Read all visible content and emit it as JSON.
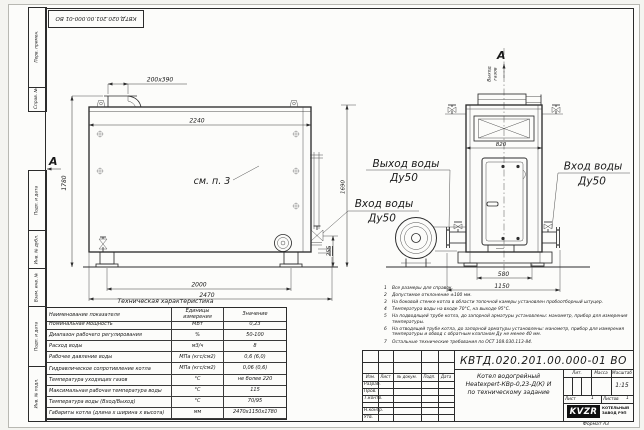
{
  "frame": {
    "strip_top": [
      "Перв. примен.",
      "Справ. №"
    ],
    "strip_bottom": [
      "Подп. и дата",
      "Инв. № дубл.",
      "Взам. инв. №",
      "Подп. и дата",
      "Инв. № подл."
    ]
  },
  "views": {
    "front": {
      "section_mark": "А",
      "see_ref": "см. п. 3",
      "dim_duct": "200х390",
      "dim_width_top": "2240",
      "dim_height": "1780",
      "dim_feet_span": "2000",
      "dim_length": "2470",
      "dim_inlet_height": "255",
      "dim_total_height": "1690"
    },
    "side": {
      "section_mark": "А",
      "gas_outlet_line1": "Выход",
      "gas_outlet_line2": "газов",
      "dim_width": "820",
      "dim_feet_span": "580",
      "dim_depth": "1150"
    },
    "labels": {
      "water_outlet": "Выход воды",
      "water_outlet_dn": "Ду50",
      "water_inlet_front": "Вход воды",
      "water_inlet_front_dn": "Ду50",
      "water_inlet_side": "Вход воды",
      "water_inlet_side_dn": "Ду50"
    }
  },
  "notes": [
    {
      "n": "1",
      "text": "Все размеры для справок."
    },
    {
      "n": "2",
      "text": "Допустимое отклонение ±100 мм."
    },
    {
      "n": "3",
      "text": "На боковой стенке котла в области топочной камеры установлен пробоотборный штуцер."
    },
    {
      "n": "4",
      "text": "Температура воды на входе 70°С, на выходе 95°С."
    },
    {
      "n": "5",
      "text": "На подводящей трубе котла, до запорной арматуры установлены: манометр, прибор для измерения температуры."
    },
    {
      "n": "6",
      "text": "На отводящей трубе котла, до запорной арматуры установлены: манометр, прибор для измерения температуры и обвод с обратным клапаном Ду не менее 40 мм."
    },
    {
      "n": "7",
      "text": "Остальные технические требования по ОСТ 108.030.113-84."
    }
  ],
  "tech_table": {
    "title": "Техническая характеристика",
    "headers": {
      "name": "Наименование показателя",
      "unit": "Единицы измерения",
      "value": "Значение"
    },
    "rows": [
      {
        "name": "Номинальная мощность",
        "unit": "МВт",
        "value": "0,23"
      },
      {
        "name": "Диапазон рабочего регулирования",
        "unit": "%",
        "value": "50-100"
      },
      {
        "name": "Расход воды",
        "unit": "м3/ч",
        "value": "8"
      },
      {
        "name": "Рабочее давление воды",
        "unit": "МПа (кгс/см2)",
        "value": "0,6 (6,0)"
      },
      {
        "name": "Гидравлическое сопротивление котла",
        "unit": "МПа (кгс/см2)",
        "value": "0,06 (0,6)"
      },
      {
        "name": "Температура уходящих газов",
        "unit": "°С",
        "value": "не более 220"
      },
      {
        "name": "Максимальная рабочая температура воды",
        "unit": "°С",
        "value": "115"
      },
      {
        "name": "Температура воды (Вход/Выход)",
        "unit": "°С",
        "value": "70/95"
      },
      {
        "name": "Габариты котла (длина х ширина х высота)",
        "unit": "мм",
        "value": "2470х1150х1780"
      }
    ]
  },
  "title_block": {
    "doc_number": "КВТД.020.201.00.000-01 ВО",
    "product_line1": "Котел водогрейный",
    "product_line2": "Heatexpert-КВр-0,23-Д(К) И",
    "product_line3": "по техническому задание",
    "col_izm": "Изм.",
    "col_list": "Лист",
    "col_doc": "№ докум.",
    "col_podp": "Подп.",
    "col_data": "Дата",
    "row_razrab": "Разраб.",
    "row_prov": "Пров.",
    "row_tkontr": "Т.контр.",
    "row_nkontr": "Н.контр.",
    "row_utv": "Утв.",
    "lit_label": "Лит.",
    "mass_label": "Масса",
    "scale_label": "Масштаб",
    "scale_value": "1:15",
    "sheet_label": "Лист",
    "sheet_value": "1",
    "sheets_label": "Листов",
    "sheets_value": "1",
    "logo": "KVZR",
    "company_line1": "КОТЕЛЬНЫЙ",
    "company_line2": "ЗАВОД РЭП",
    "format_label": "Формат А3"
  }
}
